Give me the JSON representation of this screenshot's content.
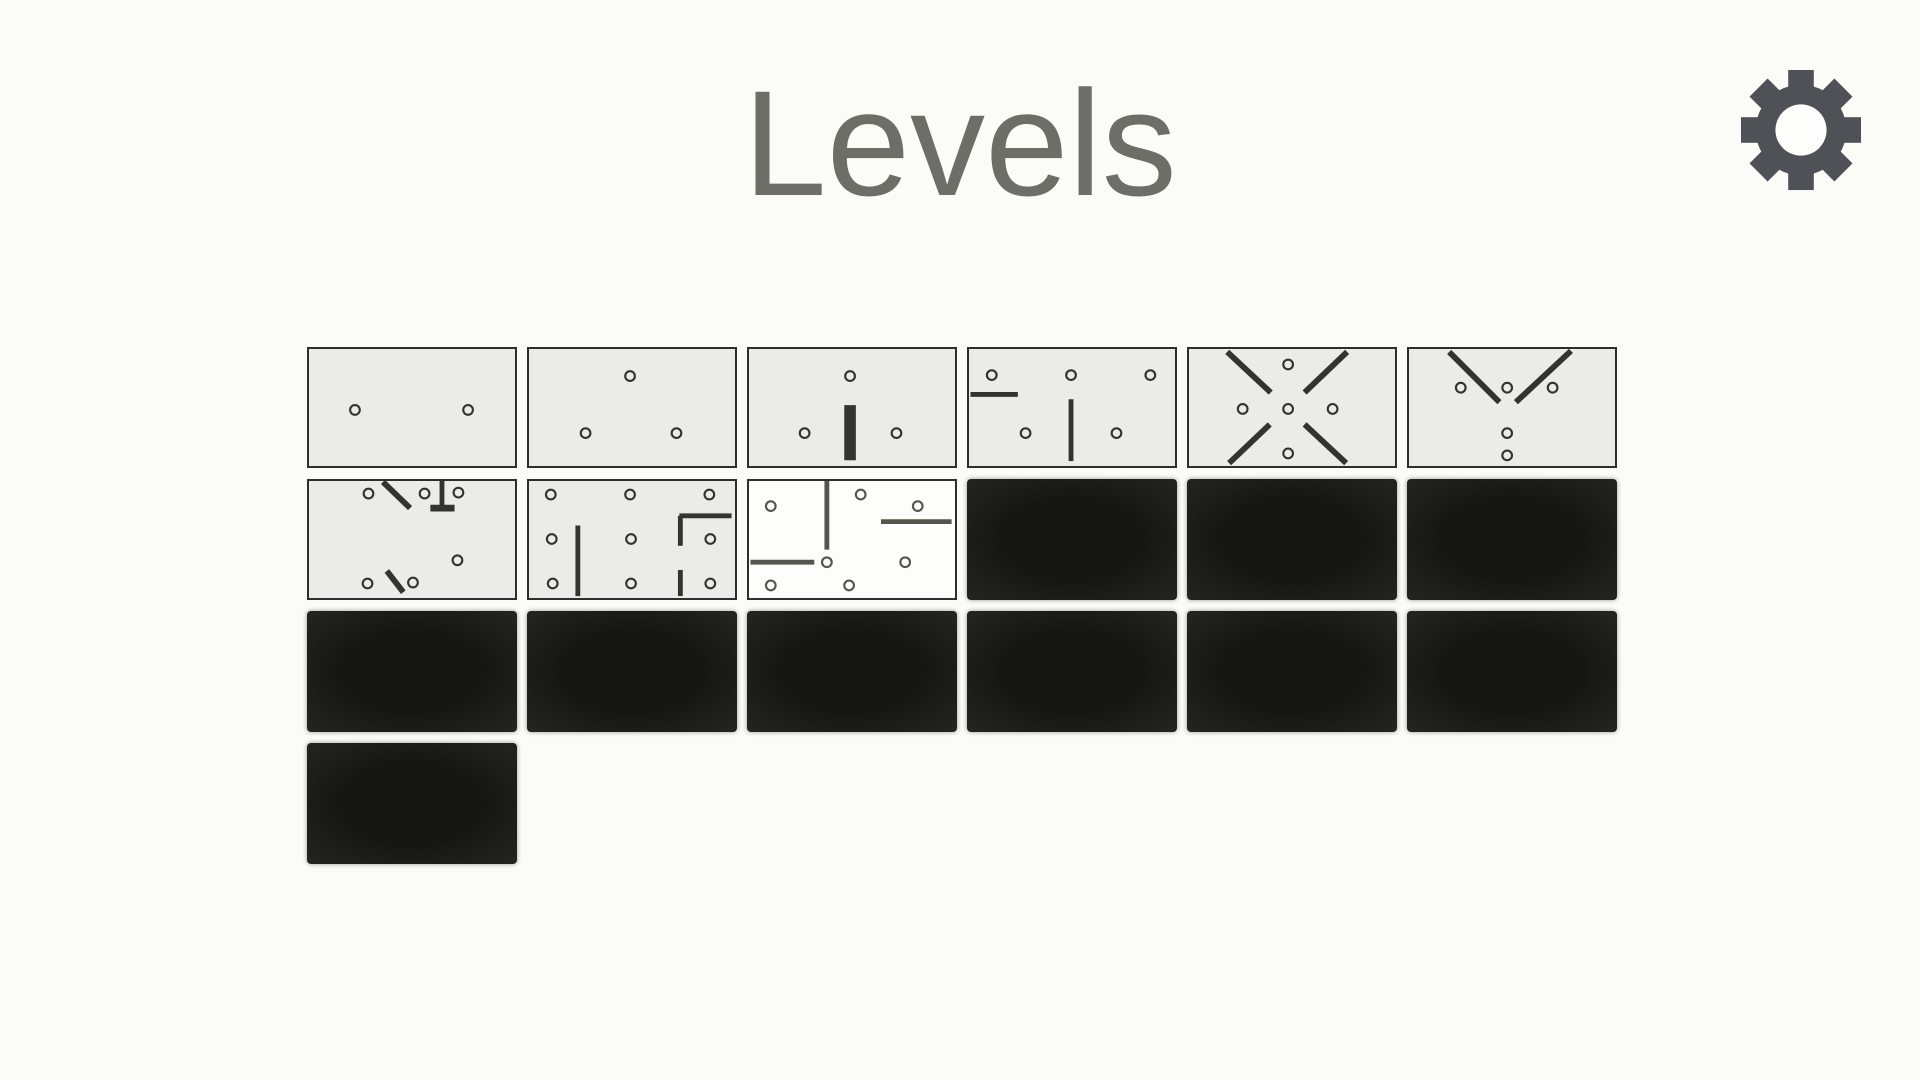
{
  "page": {
    "title": "Levels"
  },
  "colors": {
    "page_bg": "#fbfbf8",
    "title_text": "#6e6e68",
    "tile_bg": "#ebebe9",
    "tile_border": "#2e2e2b",
    "tile_current_bg": "#fdfdfc",
    "tile_locked_bg": "#1b1b18",
    "pattern_stroke": "#333330",
    "pattern_stroke_current": "#55554f",
    "gear": "#4f5156",
    "gear_hole": "#fdfdfb"
  },
  "settings": {
    "icon": "gear-icon"
  },
  "pattern_style": {
    "circle_radius": 5,
    "circle_stroke_width": 2.2,
    "default_line_width": 5
  },
  "levels": [
    {
      "id": 1,
      "state": "unlocked",
      "pattern": {
        "circles": [
          [
            46,
            63
          ],
          [
            163,
            63
          ]
        ],
        "lines": []
      }
    },
    {
      "id": 2,
      "state": "unlocked",
      "pattern": {
        "circles": [
          [
            103,
            28
          ],
          [
            57,
            87
          ],
          [
            151,
            87
          ]
        ],
        "lines": []
      }
    },
    {
      "id": 3,
      "state": "unlocked",
      "pattern": {
        "circles": [
          [
            103,
            28
          ],
          [
            56,
            87
          ],
          [
            151,
            87
          ]
        ],
        "lines": [
          [
            103,
            58,
            103,
            115,
            12
          ]
        ]
      }
    },
    {
      "id": 4,
      "state": "unlocked",
      "pattern": {
        "circles": [
          [
            22,
            27
          ],
          [
            104,
            27
          ],
          [
            186,
            27
          ],
          [
            57,
            87
          ],
          [
            151,
            87
          ]
        ],
        "lines": [
          [
            0,
            47,
            49,
            47,
            5
          ],
          [
            104,
            52,
            104,
            116,
            5
          ]
        ]
      }
    },
    {
      "id": 5,
      "state": "unlocked",
      "pattern": {
        "circles": [
          [
            101,
            16
          ],
          [
            54,
            62
          ],
          [
            101,
            62
          ],
          [
            147,
            62
          ],
          [
            101,
            108
          ]
        ],
        "lines": [
          [
            38,
            3,
            83,
            45,
            6
          ],
          [
            162,
            3,
            118,
            45,
            6
          ],
          [
            40,
            118,
            82,
            78,
            6
          ],
          [
            161,
            118,
            118,
            78,
            6
          ]
        ]
      }
    },
    {
      "id": 6,
      "state": "unlocked",
      "pattern": {
        "circles": [
          [
            52,
            40
          ],
          [
            100,
            40
          ],
          [
            147,
            40
          ],
          [
            100,
            87
          ],
          [
            100,
            110
          ]
        ],
        "lines": [
          [
            40,
            3,
            92,
            55,
            6
          ],
          [
            166,
            2,
            109,
            55,
            6
          ]
        ]
      }
    },
    {
      "id": 7,
      "state": "unlocked",
      "pattern": {
        "circles": [
          [
            60,
            13
          ],
          [
            118,
            13
          ],
          [
            153,
            12
          ],
          [
            152,
            82
          ],
          [
            59,
            106
          ],
          [
            106,
            105
          ]
        ],
        "lines": [
          [
            75,
            1,
            103,
            28,
            6
          ],
          [
            136,
            0,
            136,
            29,
            5
          ],
          [
            124,
            28,
            149,
            28,
            7
          ],
          [
            79,
            93,
            96,
            115,
            6
          ]
        ]
      }
    },
    {
      "id": 8,
      "state": "unlocked",
      "pattern": {
        "circles": [
          [
            21,
            14
          ],
          [
            103,
            14
          ],
          [
            185,
            14
          ],
          [
            22,
            60
          ],
          [
            104,
            60
          ],
          [
            186,
            60
          ],
          [
            23,
            106
          ],
          [
            104,
            106
          ],
          [
            186,
            106
          ]
        ],
        "lines": [
          [
            49,
            46,
            49,
            119,
            5
          ],
          [
            154,
            36,
            208,
            36,
            5
          ],
          [
            155,
            36,
            155,
            67,
            5
          ],
          [
            155,
            92,
            155,
            119,
            5
          ]
        ]
      }
    },
    {
      "id": 9,
      "state": "current",
      "pattern": {
        "circles": [
          [
            21,
            26
          ],
          [
            114,
            14
          ],
          [
            173,
            26
          ],
          [
            79,
            84
          ],
          [
            160,
            84
          ],
          [
            21,
            108
          ],
          [
            102,
            108
          ]
        ],
        "lines": [
          [
            79,
            0,
            79,
            71,
            5
          ],
          [
            135,
            42,
            208,
            42,
            5
          ],
          [
            0,
            84,
            66,
            84,
            5
          ]
        ]
      }
    },
    {
      "id": 10,
      "state": "locked"
    },
    {
      "id": 11,
      "state": "locked"
    },
    {
      "id": 12,
      "state": "locked"
    },
    {
      "id": 13,
      "state": "locked"
    },
    {
      "id": 14,
      "state": "locked"
    },
    {
      "id": 15,
      "state": "locked"
    },
    {
      "id": 16,
      "state": "locked"
    },
    {
      "id": 17,
      "state": "locked"
    },
    {
      "id": 18,
      "state": "locked"
    },
    {
      "id": 19,
      "state": "locked"
    }
  ]
}
